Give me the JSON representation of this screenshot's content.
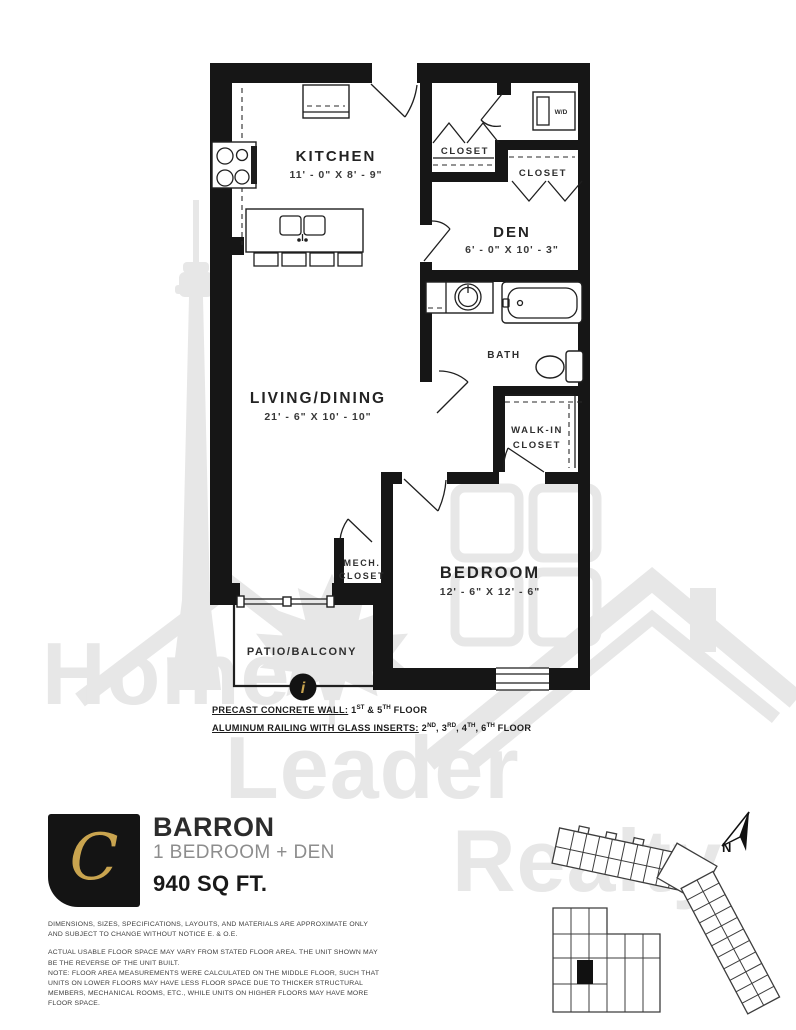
{
  "colors": {
    "wall": "#161616",
    "gold": "#c9a44f",
    "watermark_gray": "#e7e7e7",
    "text_dark": "#262626",
    "text_gray": "#8d8d8d"
  },
  "watermark": {
    "words": [
      "Home",
      "Leader",
      "Realty"
    ]
  },
  "plan": {
    "rooms": {
      "kitchen": {
        "label": "KITCHEN",
        "dims": "11' - 0\" X 8' - 9\""
      },
      "closet_entry": {
        "label": "CLOSET"
      },
      "closet_den": {
        "label": "CLOSET"
      },
      "washer_dryer": {
        "label": "W/D"
      },
      "den": {
        "label": "DEN",
        "dims": "6' - 0\" X 10' - 3\""
      },
      "bath": {
        "label": "BATH"
      },
      "living_dining": {
        "label": "LIVING/DINING",
        "dims": "21' - 6\" X 10' - 10\""
      },
      "walk_in_closet": {
        "line1": "WALK-IN",
        "line2": "CLOSET"
      },
      "mech_closet": {
        "line1": "MECH.",
        "line2": "CLOSET"
      },
      "bedroom": {
        "label": "BEDROOM",
        "dims": "12' - 6\" X 12' - 6\""
      },
      "patio": {
        "label": "PATIO/BALCONY"
      }
    },
    "info_marker": "i",
    "notes": [
      {
        "underlined": "PRECAST CONCRETE WALL:",
        "segments": [
          {
            "text": " 1"
          },
          {
            "text": "ST",
            "sup": true
          },
          {
            "text": " & 5"
          },
          {
            "text": "TH",
            "sup": true
          },
          {
            "text": " FLOOR"
          }
        ]
      },
      {
        "underlined": "ALUMINUM RAILING WITH GLASS INSERTS:",
        "segments": [
          {
            "text": " 2"
          },
          {
            "text": "ND",
            "sup": true
          },
          {
            "text": ", 3"
          },
          {
            "text": "RD",
            "sup": true
          },
          {
            "text": ", 4"
          },
          {
            "text": "TH",
            "sup": true
          },
          {
            "text": ", 6"
          },
          {
            "text": "TH",
            "sup": true
          },
          {
            "text": " FLOOR"
          }
        ]
      }
    ]
  },
  "unit": {
    "logo_letter": "C",
    "name": "BARRON",
    "type": "1 BEDROOM + DEN",
    "area": "940 SQ FT."
  },
  "keyplan": {
    "north_label": "N"
  },
  "disclaimer": {
    "p1": "DIMENSIONS, SIZES, SPECIFICATIONS, LAYOUTS, AND MATERIALS ARE APPROXIMATE ONLY AND SUBJECT TO CHANGE WITHOUT NOTICE E. & O.E.",
    "p2": "ACTUAL USABLE FLOOR SPACE MAY VARY FROM STATED FLOOR AREA. THE UNIT SHOWN MAY BE THE REVERSE OF THE UNIT BUILT.",
    "p3": "NOTE: FLOOR AREA MEASUREMENTS WERE CALCULATED ON THE MIDDLE FLOOR, SUCH THAT UNITS ON LOWER FLOORS MAY HAVE LESS FLOOR SPACE DUE TO THICKER STRUCTURAL MEMBERS, MECHANICAL ROOMS, ETC., WHILE UNITS ON HIGHER FLOORS MAY HAVE MORE FLOOR SPACE."
  }
}
